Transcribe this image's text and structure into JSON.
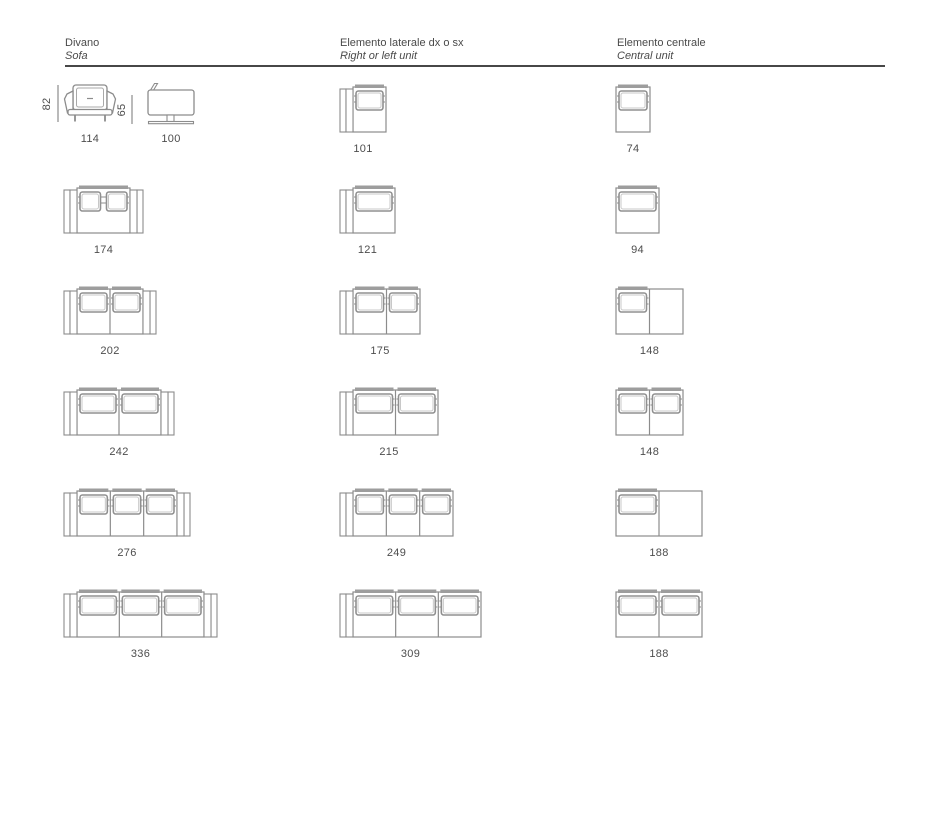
{
  "header": {
    "columns": [
      {
        "title": "Divano",
        "subtitle": "Sofa"
      },
      {
        "title": "Elemento laterale dx o sx",
        "subtitle": "Right or left unit"
      },
      {
        "title": "Elemento centrale",
        "subtitle": "Central unit"
      }
    ]
  },
  "colors": {
    "ink_text": "#4d4d4d",
    "drawing_line": "#8c8c8c",
    "backrest_bar": "#9d9d9d",
    "divider": "#474747"
  },
  "dimension_views": {
    "front": {
      "height_cm": "82",
      "width_cm": "114"
    },
    "side": {
      "height_cm": "65",
      "depth_cm": "100"
    }
  },
  "units": [
    {
      "row": 0,
      "col": 1,
      "width_cm": 101,
      "seats": 1,
      "arm": "left",
      "divided": false,
      "cushions": [
        true
      ],
      "label": "101"
    },
    {
      "row": 0,
      "col": 2,
      "width_cm": 74,
      "seats": 1,
      "arm": "none",
      "divided": false,
      "cushions": [
        true
      ],
      "label": "74"
    },
    {
      "row": 1,
      "col": 0,
      "width_cm": 174,
      "seats": 2,
      "arm": "both",
      "divided": false,
      "cushions": [
        true,
        true
      ],
      "label": "174"
    },
    {
      "row": 1,
      "col": 1,
      "width_cm": 121,
      "seats": 1,
      "arm": "left",
      "divided": false,
      "cushions": [
        true
      ],
      "label": "121"
    },
    {
      "row": 1,
      "col": 2,
      "width_cm": 94,
      "seats": 1,
      "arm": "none",
      "divided": false,
      "cushions": [
        true
      ],
      "label": "94"
    },
    {
      "row": 2,
      "col": 0,
      "width_cm": 202,
      "seats": 2,
      "arm": "both",
      "divided": true,
      "cushions": [
        true,
        true
      ],
      "label": "202"
    },
    {
      "row": 2,
      "col": 1,
      "width_cm": 175,
      "seats": 2,
      "arm": "left",
      "divided": true,
      "cushions": [
        true,
        true
      ],
      "label": "175"
    },
    {
      "row": 2,
      "col": 2,
      "width_cm": 148,
      "seats": 2,
      "arm": "none",
      "divided": true,
      "cushions": [
        true,
        false
      ],
      "label": "148"
    },
    {
      "row": 3,
      "col": 0,
      "width_cm": 242,
      "seats": 2,
      "arm": "both",
      "divided": true,
      "cushions": [
        true,
        true
      ],
      "label": "242"
    },
    {
      "row": 3,
      "col": 1,
      "width_cm": 215,
      "seats": 2,
      "arm": "left",
      "divided": true,
      "cushions": [
        true,
        true
      ],
      "label": "215"
    },
    {
      "row": 3,
      "col": 2,
      "width_cm": 148,
      "seats": 2,
      "arm": "none",
      "divided": true,
      "cushions": [
        true,
        true
      ],
      "label": "148"
    },
    {
      "row": 4,
      "col": 0,
      "width_cm": 276,
      "seats": 3,
      "arm": "both",
      "divided": true,
      "cushions": [
        true,
        true,
        true
      ],
      "label": "276"
    },
    {
      "row": 4,
      "col": 1,
      "width_cm": 249,
      "seats": 3,
      "arm": "left",
      "divided": true,
      "cushions": [
        true,
        true,
        true
      ],
      "label": "249"
    },
    {
      "row": 4,
      "col": 2,
      "width_cm": 188,
      "seats": 2,
      "arm": "none",
      "divided": true,
      "cushions": [
        true,
        false
      ],
      "label": "188"
    },
    {
      "row": 5,
      "col": 0,
      "width_cm": 336,
      "seats": 3,
      "arm": "both",
      "divided": true,
      "cushions": [
        true,
        true,
        true
      ],
      "label": "336"
    },
    {
      "row": 5,
      "col": 1,
      "width_cm": 309,
      "seats": 3,
      "arm": "left",
      "divided": true,
      "cushions": [
        true,
        true,
        true
      ],
      "label": "309"
    },
    {
      "row": 5,
      "col": 2,
      "width_cm": 188,
      "seats": 2,
      "arm": "none",
      "divided": true,
      "cushions": [
        true,
        true
      ],
      "label": "188"
    }
  ]
}
